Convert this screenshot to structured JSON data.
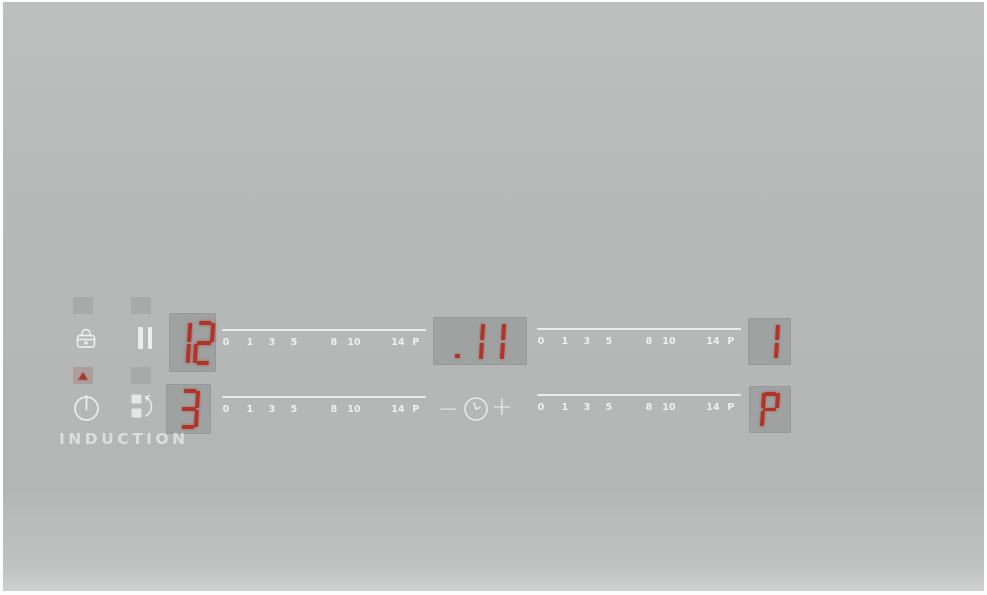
{
  "panel": {
    "brand": "INDUCTION",
    "colors": {
      "background": "#b6b9b8",
      "display_background": "#9ea2a1",
      "segment_red": "#b23429",
      "icon_white": "#f2f5f4",
      "led_on_red": "#a8352a"
    }
  },
  "scale": {
    "labels": [
      "0",
      "1",
      "3",
      "5",
      "8",
      "10",
      "14",
      "P"
    ]
  },
  "zones": {
    "left_rear": {
      "level": "12"
    },
    "left_front": {
      "level": "3"
    },
    "right_rear": {
      "level": "1"
    },
    "right_front": {
      "level": "P"
    }
  },
  "timer": {
    "display": ".11",
    "minus": "−",
    "plus": "+"
  },
  "indicators": {
    "lock_led": "off",
    "pause_led": "off",
    "power_led": "on",
    "bridge_led": "off"
  },
  "icons": {
    "lock": "child-lock",
    "pause": "pause",
    "power": "power-on-off",
    "bridge": "zone-bridge",
    "clock": "timer-clock"
  }
}
